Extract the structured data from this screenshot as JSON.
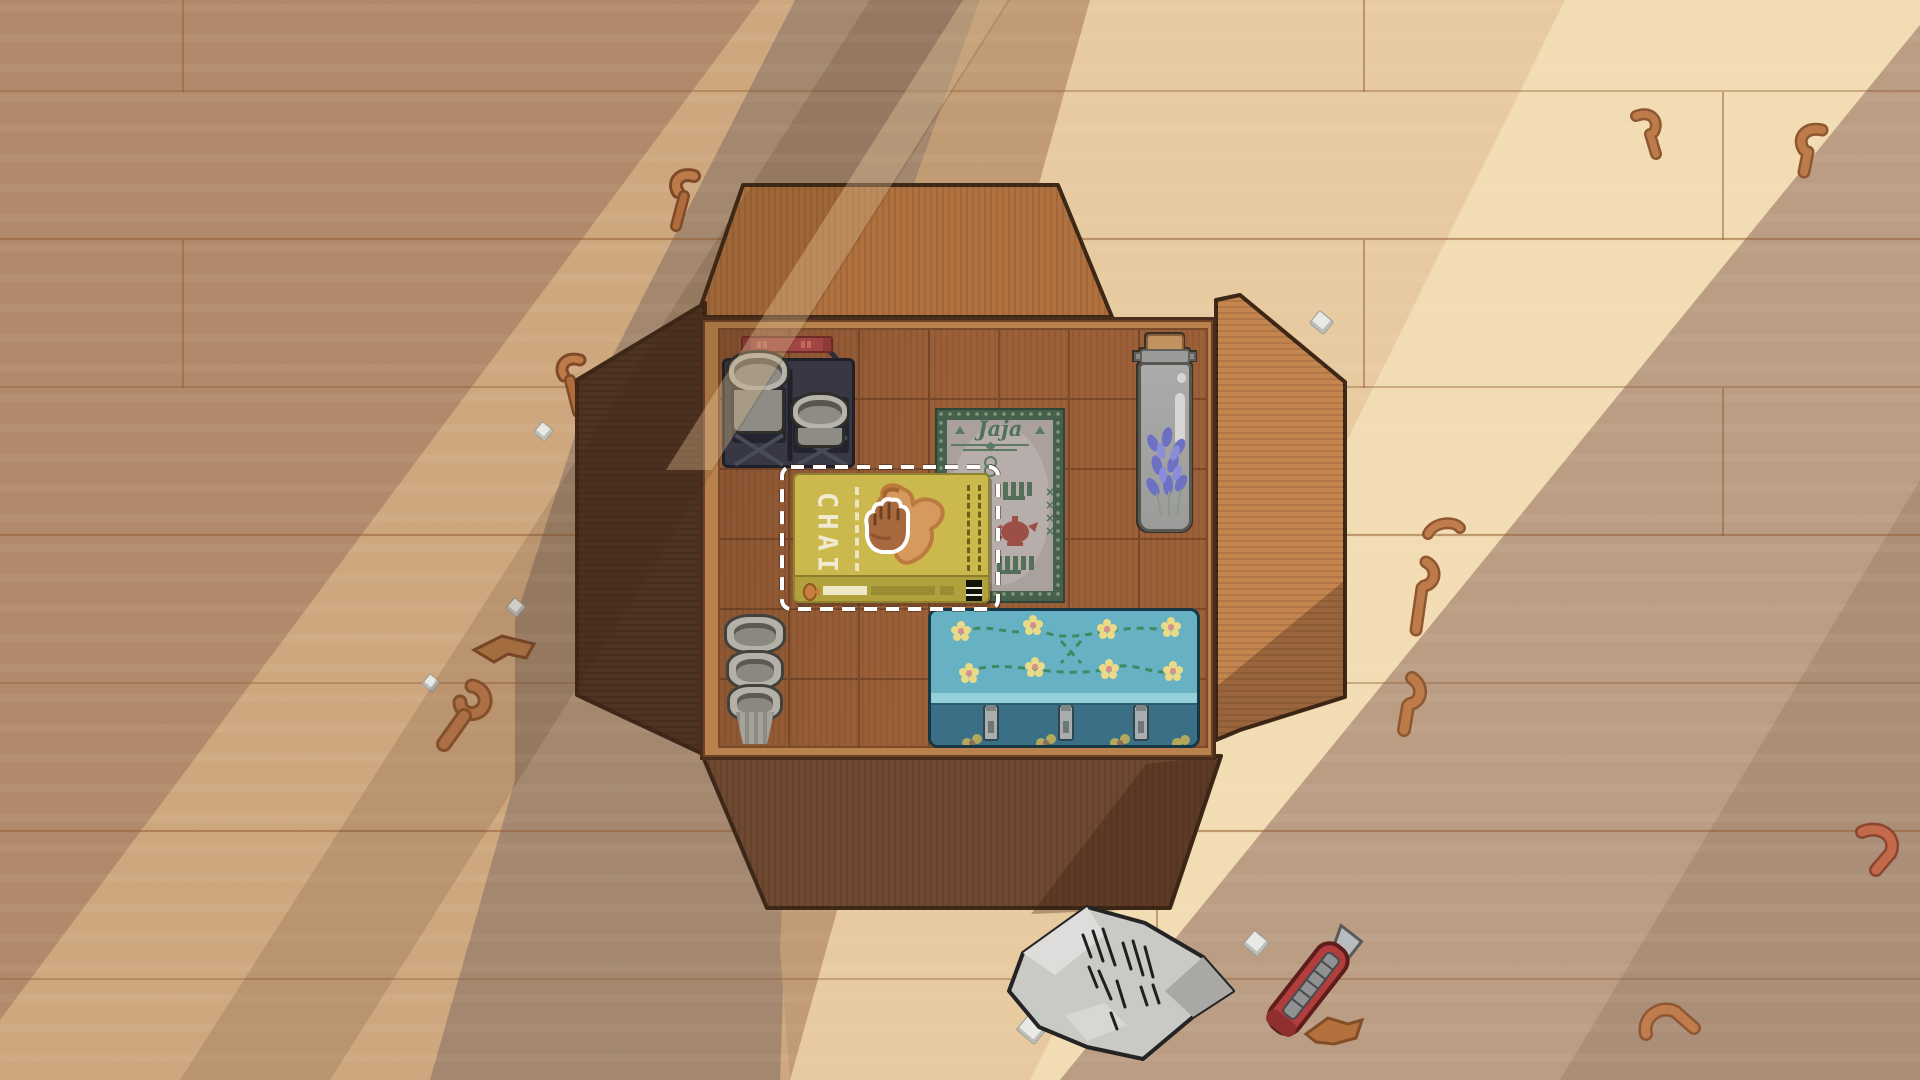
{
  "labels": {
    "chai": "CHAI",
    "jaja": "Jaja",
    "jaja_marks": "××"
  },
  "held_item": {
    "name": "chai-tea-box",
    "state": "selected-dragging"
  },
  "box_contents": [
    "pot-caddy-basket",
    "chai-tea-box",
    "jaja-book",
    "lavender-jar",
    "stacked-cups",
    "floral-tin"
  ],
  "floor_objects": [
    "crumpled-packing-paper",
    "box-cutter",
    "cardboard-scraps",
    "paper-crumbs"
  ],
  "colors": {
    "selection_dash": "#ffffff",
    "chai_box": "#cbb94d",
    "chai_text": "#f0ead0",
    "tin_teal": "#67b1c4",
    "tin_dark": "#3b6f85",
    "book_green": "#45604b",
    "lavender": "#6d71c4",
    "cutter_red": "#b23d3d",
    "box_interior": "#9c6038",
    "floor_bright": "#f2dcb3",
    "floor_shadow": "#a3876e"
  }
}
